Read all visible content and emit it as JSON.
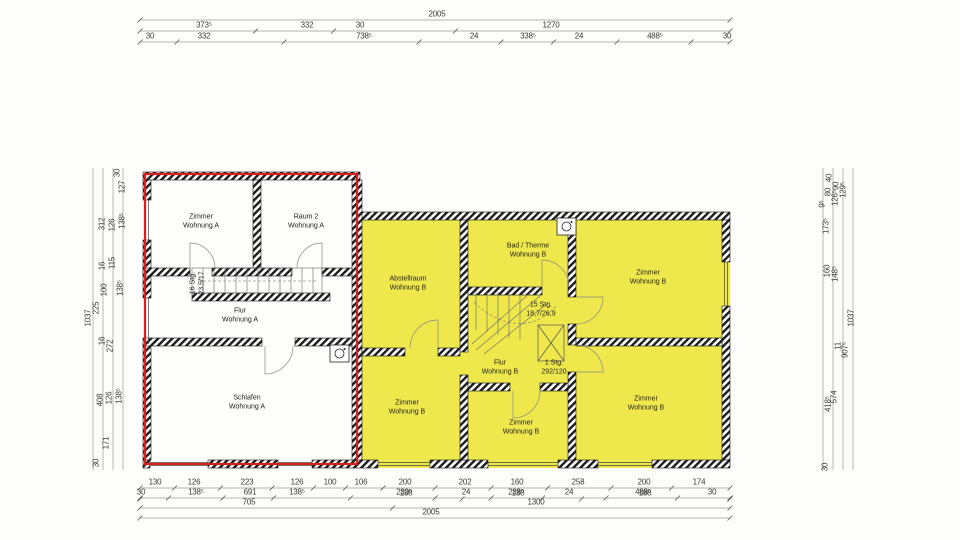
{
  "colors": {
    "wohnung_b_fill": "#efe84d",
    "wohnung_a_outline": "#d42020",
    "wall_hatch": "#1c1c1c",
    "dim_line": "#9a9a9a",
    "dim_text": "#3a3a3a"
  },
  "rooms": [
    {
      "id": "zimmer-wohnung-a",
      "lines": [
        "Zimmer",
        "Wohnung A"
      ],
      "x": 201,
      "y": 222
    },
    {
      "id": "raum2-wohnung-a",
      "lines": [
        "Raum 2",
        "Wohnung A"
      ],
      "x": 306,
      "y": 222
    },
    {
      "id": "flur-wohnung-a",
      "lines": [
        "Flur",
        "Wohnung A"
      ],
      "x": 240,
      "y": 316
    },
    {
      "id": "schlafen-wohnung-a",
      "lines": [
        "Schlafen",
        "Wohnung A"
      ],
      "x": 247,
      "y": 403
    },
    {
      "id": "abstellraum-wohnung-b",
      "lines": [
        "Abstellraum",
        "Wohnung B"
      ],
      "x": 408,
      "y": 284
    },
    {
      "id": "bad-therme-wohnung-b",
      "lines": [
        "Bad / Therme",
        "Wohnung B"
      ],
      "x": 528,
      "y": 251
    },
    {
      "id": "zimmer-wohnung-b-oben",
      "lines": [
        "Zimmer",
        "Wohnung B"
      ],
      "x": 648,
      "y": 278
    },
    {
      "id": "flur-wohnung-b",
      "lines": [
        "Flur",
        "Wohnung B"
      ],
      "x": 500,
      "y": 368
    },
    {
      "id": "zimmer-wohnung-b-links",
      "lines": [
        "Zimmer",
        "Wohnung B"
      ],
      "x": 407,
      "y": 408
    },
    {
      "id": "zimmer-wohnung-b-mitte",
      "lines": [
        "Zimmer",
        "Wohnung B"
      ],
      "x": 521,
      "y": 428
    },
    {
      "id": "zimmer-wohnung-b-rechts",
      "lines": [
        "Zimmer",
        "Wohnung B"
      ],
      "x": 646,
      "y": 404
    },
    {
      "id": "treppe-b-beschriftung",
      "lines": [
        "15 Stg.",
        "18,7/26,9"
      ],
      "x": 541,
      "y": 310
    },
    {
      "id": "stufe-beschriftung",
      "lines": [
        "1 Stg.",
        "292/120"
      ],
      "x": 554,
      "y": 368
    },
    {
      "id": "treppe-a-beschriftung",
      "lines": [
        "16 Stg.",
        "23,5/17"
      ],
      "x": 198,
      "y": 283,
      "rot": -90
    }
  ],
  "dimensions": {
    "horizontal": [
      {
        "t": "2005",
        "x": 437,
        "y": 14
      },
      {
        "t": "373⁵",
        "x": 204,
        "y": 25
      },
      {
        "t": "332",
        "x": 307,
        "y": 25
      },
      {
        "t": "30",
        "x": 360,
        "y": 25
      },
      {
        "t": "1270",
        "x": 551,
        "y": 25
      },
      {
        "t": "30",
        "x": 150,
        "y": 36
      },
      {
        "t": "332",
        "x": 204,
        "y": 36
      },
      {
        "t": "738⁵",
        "x": 364,
        "y": 36
      },
      {
        "t": "24",
        "x": 474,
        "y": 36
      },
      {
        "t": "338⁵",
        "x": 528,
        "y": 36
      },
      {
        "t": "24",
        "x": 579,
        "y": 36
      },
      {
        "t": "488⁵",
        "x": 655,
        "y": 36
      },
      {
        "t": "30",
        "x": 727,
        "y": 36
      },
      {
        "t": "130",
        "x": 155,
        "y": 482
      },
      {
        "t": "126",
        "x": 194,
        "y": 482
      },
      {
        "t": "223",
        "x": 247,
        "y": 482
      },
      {
        "t": "126",
        "x": 297,
        "y": 482
      },
      {
        "t": "100",
        "x": 330,
        "y": 482
      },
      {
        "t": "106",
        "x": 361,
        "y": 482
      },
      {
        "t": "200",
        "x": 405,
        "y": 482
      },
      {
        "t": "202",
        "x": 465,
        "y": 482
      },
      {
        "t": "160",
        "x": 517,
        "y": 482
      },
      {
        "t": "258",
        "x": 578,
        "y": 482
      },
      {
        "t": "200",
        "x": 644,
        "y": 482
      },
      {
        "t": "174",
        "x": 699,
        "y": 482
      },
      {
        "t": "30",
        "x": 141,
        "y": 492
      },
      {
        "t": "138⁵",
        "x": 196,
        "y": 492
      },
      {
        "t": "691",
        "x": 250,
        "y": 492
      },
      {
        "t": "138⁵",
        "x": 297,
        "y": 492
      },
      {
        "t": "230⁵",
        "x": 404,
        "y": 492
      },
      {
        "t": "138",
        "x": 406,
        "y": 493
      },
      {
        "t": "24",
        "x": 466,
        "y": 492
      },
      {
        "t": "238⁵",
        "x": 516,
        "y": 492
      },
      {
        "t": "138",
        "x": 518,
        "y": 493
      },
      {
        "t": "24",
        "x": 569,
        "y": 492
      },
      {
        "t": "488⁵",
        "x": 643,
        "y": 492
      },
      {
        "t": "188",
        "x": 645,
        "y": 493
      },
      {
        "t": "30",
        "x": 712,
        "y": 492
      },
      {
        "t": "705",
        "x": 249,
        "y": 502
      },
      {
        "t": "1300",
        "x": 536,
        "y": 502
      },
      {
        "t": "2005",
        "x": 431,
        "y": 512
      }
    ],
    "vertical": [
      {
        "t": "30",
        "x": 117,
        "y": 173
      },
      {
        "t": "127",
        "x": 122,
        "y": 187
      },
      {
        "t": "312",
        "x": 102,
        "y": 224
      },
      {
        "t": "126",
        "x": 112,
        "y": 225
      },
      {
        "t": "138⁵",
        "x": 122,
        "y": 221
      },
      {
        "t": "16",
        "x": 102,
        "y": 266
      },
      {
        "t": "115",
        "x": 112,
        "y": 263
      },
      {
        "t": "100",
        "x": 104,
        "y": 290
      },
      {
        "t": "138⁵",
        "x": 120,
        "y": 288
      },
      {
        "t": "225",
        "x": 96,
        "y": 308
      },
      {
        "t": "1037",
        "x": 88,
        "y": 318
      },
      {
        "t": "16",
        "x": 102,
        "y": 341
      },
      {
        "t": "272",
        "x": 110,
        "y": 346
      },
      {
        "t": "408",
        "x": 100,
        "y": 400
      },
      {
        "t": "126",
        "x": 109,
        "y": 398
      },
      {
        "t": "138⁵",
        "x": 119,
        "y": 396
      },
      {
        "t": "171",
        "x": 106,
        "y": 443
      },
      {
        "t": "30",
        "x": 96,
        "y": 463
      },
      {
        "t": "40",
        "x": 829,
        "y": 178
      },
      {
        "t": "90",
        "x": 836,
        "y": 186
      },
      {
        "t": "80",
        "x": 828,
        "y": 192
      },
      {
        "t": "129⁵",
        "x": 843,
        "y": 190
      },
      {
        "t": "126⁵",
        "x": 835,
        "y": 198
      },
      {
        "t": "9⁵",
        "x": 822,
        "y": 204
      },
      {
        "t": "173⁵",
        "x": 826,
        "y": 226
      },
      {
        "t": "160",
        "x": 827,
        "y": 271
      },
      {
        "t": "148⁵",
        "x": 835,
        "y": 274
      },
      {
        "t": "1037",
        "x": 851,
        "y": 318
      },
      {
        "t": "11",
        "x": 838,
        "y": 346
      },
      {
        "t": "907⁵",
        "x": 845,
        "y": 350
      },
      {
        "t": "574",
        "x": 834,
        "y": 397
      },
      {
        "t": "418⁵",
        "x": 828,
        "y": 404
      },
      {
        "t": "30",
        "x": 825,
        "y": 467
      }
    ]
  }
}
